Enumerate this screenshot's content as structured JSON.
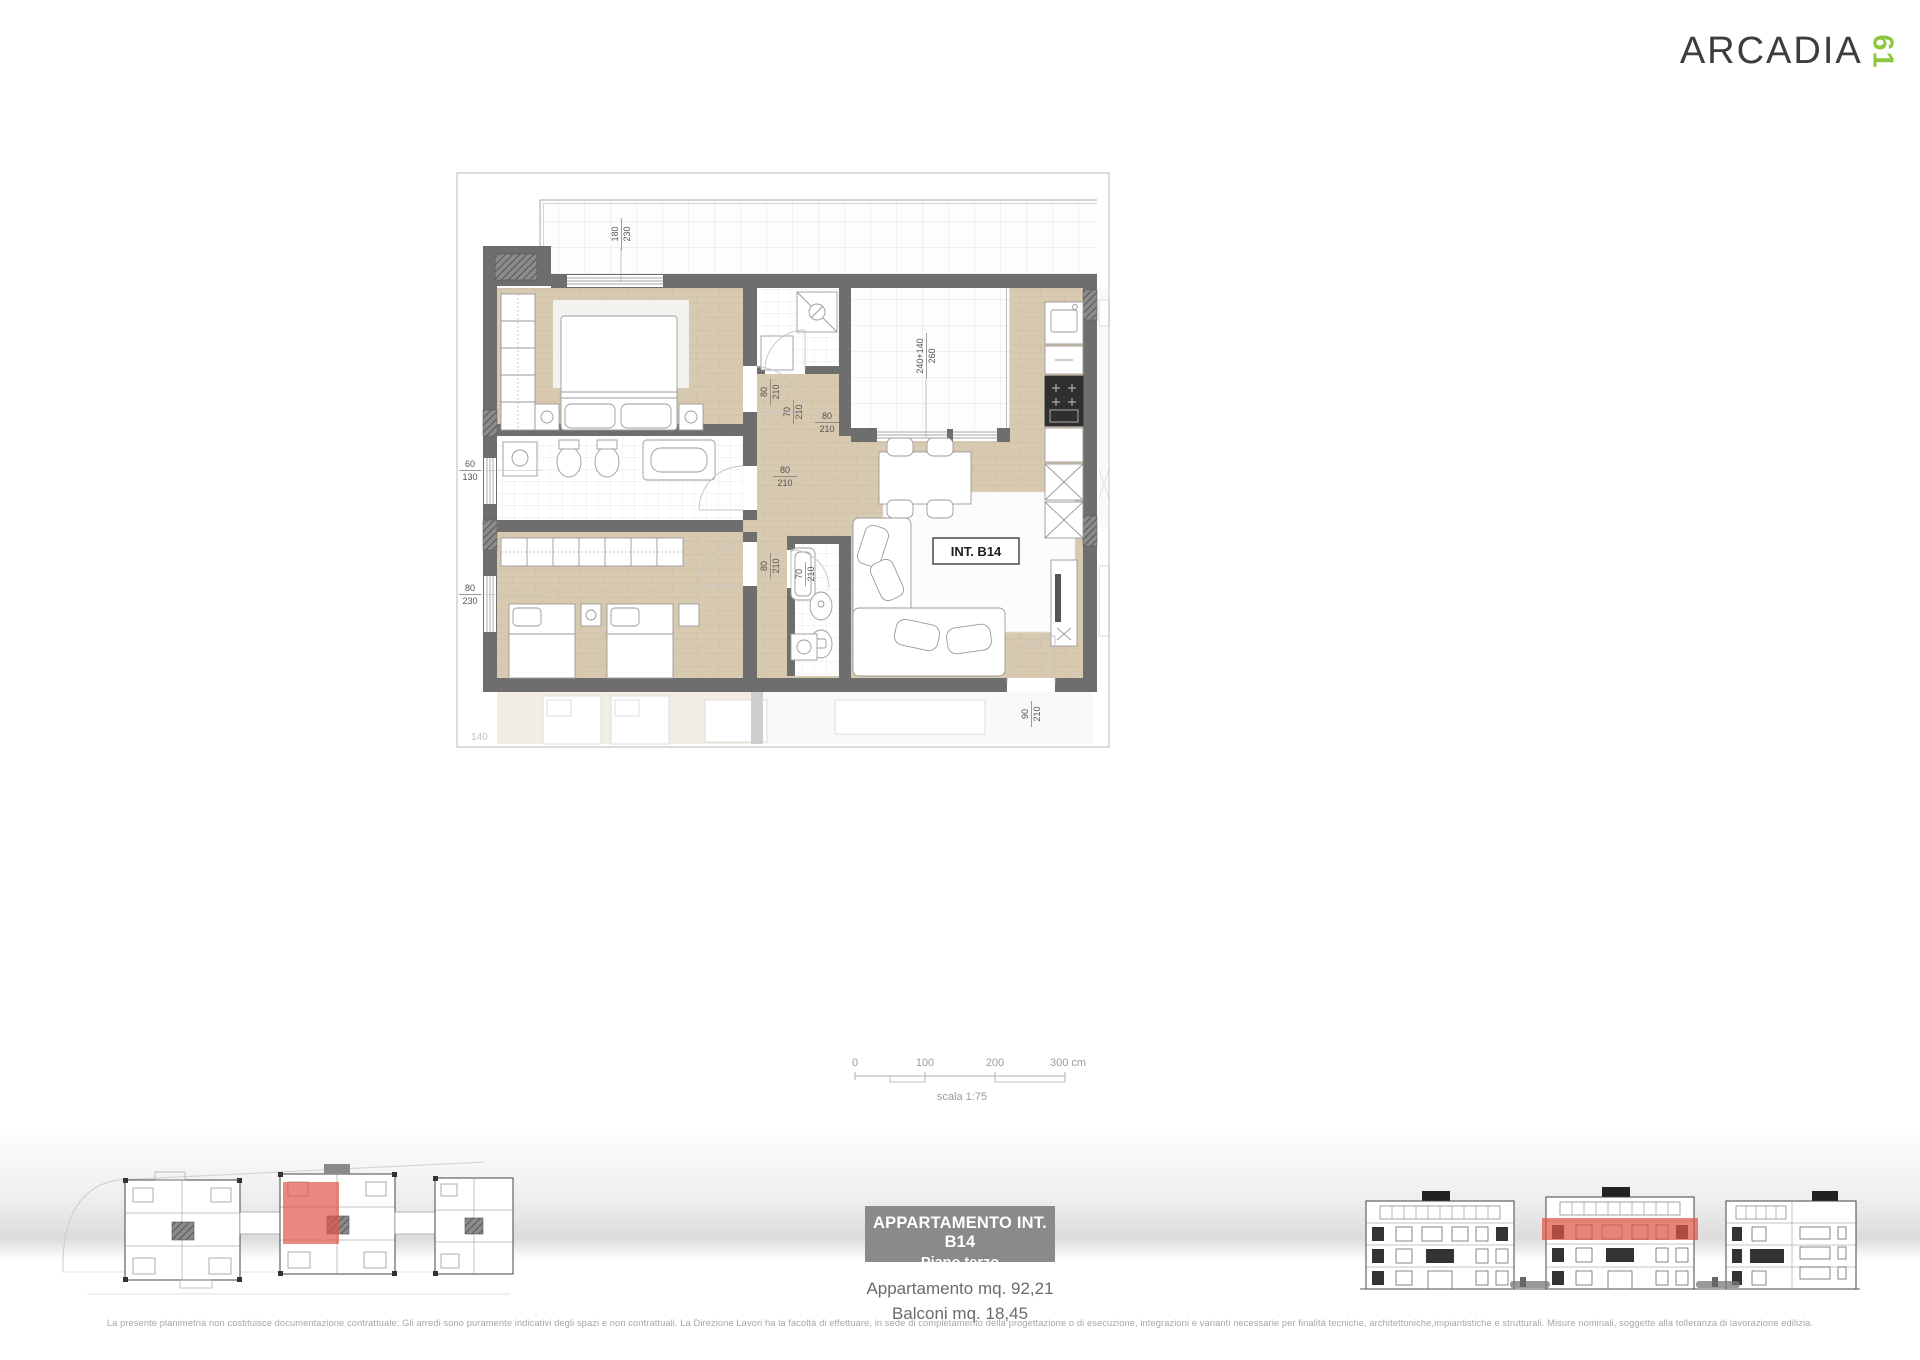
{
  "brand": {
    "name": "ARCADIA",
    "suffix": "61"
  },
  "colors": {
    "accent_green": "#8DC63F",
    "highlight_red": "#E05548",
    "wall_gray": "#6E6E6E",
    "title_bg": "#8A8A8A"
  },
  "floor_plan": {
    "unit_label": "INT. B14",
    "corner_label": "140",
    "labels": {
      "window_bedroom": {
        "num": "180",
        "den": "230"
      },
      "terrace_door": {
        "num": "240+140",
        "den": "260"
      },
      "window_bath": {
        "num": "60",
        "den": "130"
      },
      "window_bedroom2": {
        "num": "80",
        "den": "230"
      },
      "door80": {
        "num": "80",
        "den": "210"
      },
      "door70": {
        "num": "70",
        "den": "210"
      },
      "door90": {
        "num": "90",
        "den": "210"
      }
    }
  },
  "scale_bar": {
    "ticks": [
      "0",
      "100",
      "200",
      "300 cm"
    ],
    "label": "scala 1:75"
  },
  "title_block": {
    "line1": "APPARTAMENTO INT. B14",
    "line2": "Piano terzo"
  },
  "areas": {
    "apartment": "Appartamento mq. 92,21",
    "balconies": "Balconi mq. 18,45"
  },
  "disclaimer": "La presente planimetria non costituisce documentazione contrattuale. Gli arredi sono puramente indicativi degli spazi e non contrattuali. La Direzione Lavori ha la facoltà di effettuare, in sede di completamento della progettazione o di esecuzione, integrazioni e varianti necessarie per finalità tecniche, architettoniche,impiantistiche e strutturali. Misure nominali, soggette alla tolleranza di lavorazione edilizia."
}
